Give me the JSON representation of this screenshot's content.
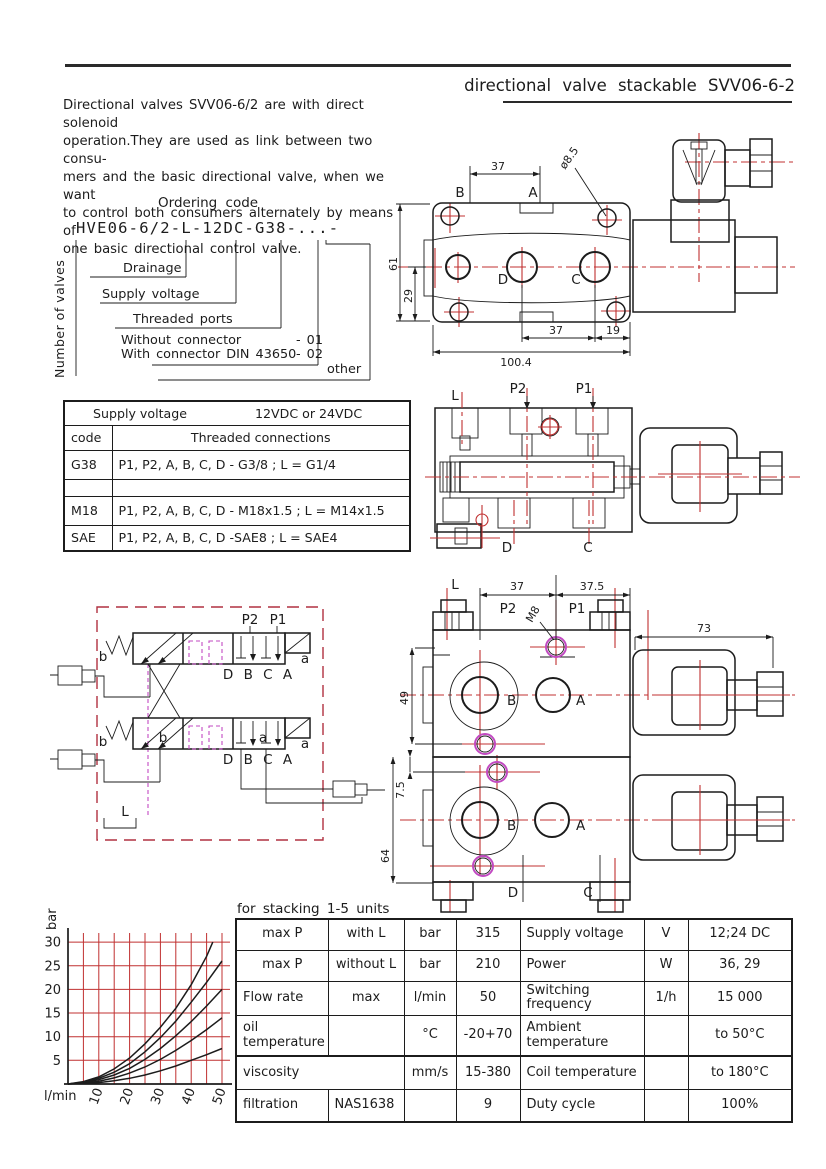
{
  "header": {
    "title": "directional valve stackable SVV06-6-2"
  },
  "intro": "Directional valves SVV06-6/2 are with direct solenoid\noperation.They are used as link between two consu-\nmers and the basic directional valve, when we want\nto control both consumers alternately by means of\none basic directional control valve.",
  "ordering": {
    "title": "Ordering code",
    "code": "HVE06-6/2-L-12DC-G38-...-",
    "number_of_valves": "Number of valves",
    "drainage": "Drainage",
    "supply_voltage": "Supply voltage",
    "threaded_ports": "Threaded ports",
    "without_connector": "Without connector",
    "without_code": "- 01",
    "with_connector": "With connector DIN 43650",
    "with_code": "- 02",
    "other": "other"
  },
  "connections_table": {
    "supply_label": "Supply voltage",
    "supply_value": "12VDC or 24VDC",
    "col_code": "code",
    "col_desc": "Threaded connections",
    "rows": [
      {
        "code": "G38",
        "desc": "P1, P2, A, B, C, D - G3/8 ; L = G1/4"
      },
      {
        "code": "",
        "desc": ""
      },
      {
        "code": "M18",
        "desc": "P1, P2, A, B, C, D - M18x1.5 ; L = M14x1.5"
      },
      {
        "code": "SAE",
        "desc": "P1, P2, A, B, C, D -SAE8 ; L = SAE4"
      }
    ]
  },
  "top_view": {
    "dim_37_top": "37",
    "dim_dia": "ø8.5",
    "port_b": "B",
    "port_a": "A",
    "port_d": "D",
    "port_c": "C",
    "dim_61": "61",
    "dim_29": "29",
    "dim_37_bottom": "37",
    "dim_19": "19",
    "dim_total": "100.4"
  },
  "section_view": {
    "label_l": "L",
    "label_p2": "P2",
    "label_p1": "P1",
    "label_d": "D",
    "label_c": "C"
  },
  "schematic": {
    "label_p2": "P2",
    "label_p1": "P1",
    "ports": "D B C A",
    "label_b": "b",
    "label_a": "a",
    "label_l": "L"
  },
  "stack_view": {
    "dim_37": "37",
    "dim_37_5": "37.5",
    "dim_m8": "M8",
    "dim_73": "73",
    "dim_49": "49",
    "dim_7_5": "7.5",
    "dim_64": "64",
    "label_l": "L",
    "label_p2": "P2",
    "label_p1": "P1",
    "port_b": "B",
    "port_a": "A",
    "label_d": "D",
    "label_c": "C"
  },
  "chart_data": {
    "type": "line",
    "xlabel": "l/min",
    "ylabel": "bar",
    "xlim": [
      0,
      50
    ],
    "ylim": [
      0,
      32
    ],
    "grid_step": 5,
    "grid_color": "#c03030",
    "x_ticks": [
      10,
      20,
      30,
      40,
      50
    ],
    "y_ticks": [
      5,
      10,
      15,
      20,
      25,
      30
    ],
    "x": [
      0,
      5,
      10,
      15,
      20,
      25,
      30,
      35,
      40,
      45,
      50
    ],
    "series": [
      {
        "name": "curve-1",
        "x": [
          0,
          5,
          10,
          15,
          20,
          25,
          30,
          35,
          40,
          45,
          47
        ],
        "values": [
          0,
          0.5,
          1.5,
          3.2,
          5.5,
          8.5,
          12,
          16,
          21,
          27,
          30
        ]
      },
      {
        "name": "curve-2",
        "values": [
          0,
          0.4,
          1.2,
          2.5,
          4.3,
          6.8,
          9.8,
          13.3,
          17.3,
          21.5,
          26
        ]
      },
      {
        "name": "curve-3",
        "values": [
          0,
          0.3,
          0.9,
          1.9,
          3.3,
          5.2,
          7.5,
          10.2,
          13.2,
          16.5,
          20
        ]
      },
      {
        "name": "curve-4",
        "values": [
          0,
          0.2,
          0.6,
          1.3,
          2.3,
          3.6,
          5.2,
          7.1,
          9.2,
          11.5,
          14
        ]
      },
      {
        "name": "curve-5",
        "values": [
          0,
          0.1,
          0.3,
          0.7,
          1.2,
          1.9,
          2.8,
          3.8,
          5.0,
          6.2,
          7.5
        ]
      }
    ]
  },
  "spec_table": {
    "caption": "for stacking 1-5 units",
    "rows": [
      [
        "max P",
        "with L",
        "bar",
        "315",
        "Supply voltage",
        "V",
        "12;24 DC"
      ],
      [
        "max P",
        "without L",
        "bar",
        "210",
        "Power",
        "W",
        "36, 29"
      ],
      [
        "Flow rate",
        "max",
        "l/min",
        "50",
        "Switching\nfrequency",
        "1/h",
        "15 000"
      ],
      [
        "oil\ntemperature",
        "",
        "°C",
        "-20+70",
        "Ambient\ntemperature",
        "",
        "to 50°C"
      ],
      [
        "viscosity",
        "",
        "mm/s",
        "15-380",
        "Coil temperature",
        "",
        "to 180°C"
      ],
      [
        "filtration",
        "NAS1638",
        "",
        "9",
        "Duty cycle",
        "",
        "100%"
      ]
    ]
  },
  "colors": {
    "accent_red": "#c03030",
    "accent_magenta": "#c24ac2",
    "line_black": "#1c1c1c"
  }
}
